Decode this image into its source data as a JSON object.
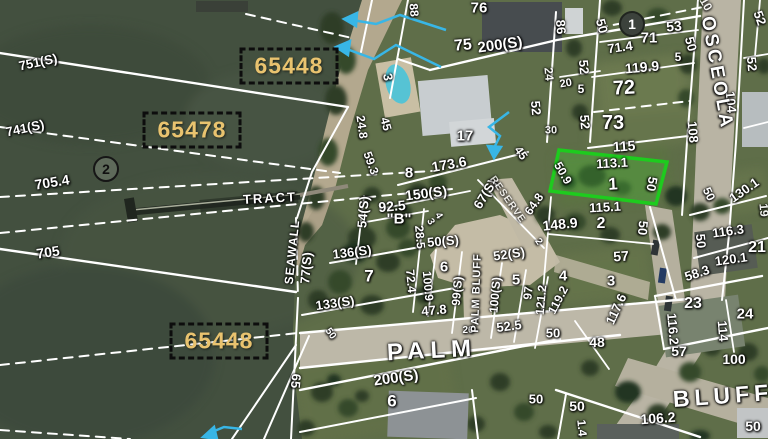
{
  "map": {
    "description": "Aerial parcel map with survey overlay",
    "colors": {
      "water": "#43503f",
      "land": "#5f6e49",
      "highlight_green": "#1ecb1e",
      "arrow_cyan": "#38b6e6",
      "parcel_id_text": "#e9c36f",
      "parcel_line": "#ffffff"
    },
    "highlight_parcel": {
      "lot": "1",
      "points": "559,150 667,162 656,204 550,191"
    },
    "parcel_id_boxes": [
      {
        "id": "65448",
        "x": 289,
        "y": 66
      },
      {
        "id": "65478",
        "x": 192,
        "y": 130
      },
      {
        "id": "65448",
        "x": 219,
        "y": 341
      }
    ],
    "circle_markers": [
      {
        "n": "2",
        "x": 106,
        "y": 169,
        "variant": "outline"
      },
      {
        "n": "1",
        "x": 632,
        "y": 24,
        "variant": "filled"
      }
    ],
    "street_labels": [
      {
        "t": "OSCEOLA",
        "x": 717,
        "y": 73,
        "r": 80,
        "s": 19,
        "sp": 3
      },
      {
        "t": "PALM",
        "x": 432,
        "y": 351,
        "r": -3,
        "s": 24,
        "sp": 6
      },
      {
        "t": "BLUFF",
        "x": 723,
        "y": 396,
        "r": -4,
        "s": 23,
        "sp": 5
      },
      {
        "t": "PALM BLUFF",
        "x": 477,
        "y": 293,
        "r": -88,
        "s": 11,
        "sp": 1
      },
      {
        "t": "SEAWALL",
        "x": 292,
        "y": 252,
        "r": -84,
        "s": 12,
        "sp": 1
      },
      {
        "t": "TRACT",
        "x": 270,
        "y": 198,
        "r": -3,
        "s": 13,
        "sp": 2
      },
      {
        "t": "RESERVE",
        "x": 507,
        "y": 200,
        "r": 55,
        "s": 10,
        "sp": 1,
        "o": 0.75
      }
    ],
    "labels": [
      {
        "t": "751(S)",
        "x": 38,
        "y": 62,
        "r": -12,
        "s": 13
      },
      {
        "t": "741(S)",
        "x": 25,
        "y": 128,
        "r": -12,
        "s": 13
      },
      {
        "t": "705.4",
        "x": 52,
        "y": 182,
        "r": -9,
        "s": 14
      },
      {
        "t": "705",
        "x": 48,
        "y": 252,
        "r": -8,
        "s": 14
      },
      {
        "t": "65",
        "x": 296,
        "y": 381,
        "r": 95,
        "s": 13
      },
      {
        "t": "88",
        "x": 414,
        "y": 10,
        "r": 85,
        "s": 12
      },
      {
        "t": "76",
        "x": 479,
        "y": 8,
        "r": 0,
        "s": 15
      },
      {
        "t": "75",
        "x": 463,
        "y": 46,
        "r": -5,
        "s": 16
      },
      {
        "t": "200(S)",
        "x": 500,
        "y": 45,
        "r": -8,
        "s": 15
      },
      {
        "t": "3",
        "x": 388,
        "y": 77,
        "r": 80,
        "s": 13
      },
      {
        "t": "24.8",
        "x": 362,
        "y": 127,
        "r": 82,
        "s": 12
      },
      {
        "t": "45",
        "x": 386,
        "y": 124,
        "r": 75,
        "s": 12
      },
      {
        "t": "17",
        "x": 465,
        "y": 136,
        "r": 0,
        "s": 15
      },
      {
        "t": "52",
        "x": 536,
        "y": 108,
        "r": 85,
        "s": 13
      },
      {
        "t": "59.3",
        "x": 371,
        "y": 163,
        "r": 70,
        "s": 12
      },
      {
        "t": "86",
        "x": 561,
        "y": 27,
        "r": 85,
        "s": 13
      },
      {
        "t": "50",
        "x": 602,
        "y": 26,
        "r": 75,
        "s": 13
      },
      {
        "t": "71",
        "x": 649,
        "y": 38,
        "r": 0,
        "s": 15
      },
      {
        "t": "53",
        "x": 674,
        "y": 26,
        "r": -5,
        "s": 14
      },
      {
        "t": "71.4",
        "x": 620,
        "y": 47,
        "r": -8,
        "s": 13
      },
      {
        "t": "50",
        "x": 691,
        "y": 44,
        "r": 75,
        "s": 13
      },
      {
        "t": "5",
        "x": 678,
        "y": 57,
        "r": 0,
        "s": 12
      },
      {
        "t": "119.9",
        "x": 642,
        "y": 67,
        "r": -5,
        "s": 14
      },
      {
        "t": "52",
        "x": 584,
        "y": 67,
        "r": 85,
        "s": 13
      },
      {
        "t": "72",
        "x": 624,
        "y": 88,
        "r": -3,
        "s": 20
      },
      {
        "t": "24",
        "x": 549,
        "y": 74,
        "r": 85,
        "s": 12,
        "o": 0.9
      },
      {
        "t": "20",
        "x": 566,
        "y": 84,
        "r": -10,
        "s": 11
      },
      {
        "t": "5",
        "x": 581,
        "y": 89,
        "r": 0,
        "s": 12
      },
      {
        "t": "52",
        "x": 585,
        "y": 122,
        "r": 85,
        "s": 13
      },
      {
        "t": "73",
        "x": 613,
        "y": 123,
        "r": 0,
        "s": 20
      },
      {
        "t": "30",
        "x": 551,
        "y": 131,
        "r": 0,
        "s": 11,
        "o": 0.9
      },
      {
        "t": "115",
        "x": 624,
        "y": 146,
        "r": -4,
        "s": 14
      },
      {
        "t": "108",
        "x": 693,
        "y": 132,
        "r": 85,
        "s": 13
      },
      {
        "t": "104",
        "x": 731,
        "y": 102,
        "r": 85,
        "s": 13
      },
      {
        "t": "52",
        "x": 760,
        "y": 18,
        "r": 70,
        "s": 13
      },
      {
        "t": "52",
        "x": 752,
        "y": 64,
        "r": 85,
        "s": 13
      },
      {
        "t": "10",
        "x": 706,
        "y": 4,
        "r": 60,
        "s": 12,
        "o": 0.85
      },
      {
        "t": "8",
        "x": 409,
        "y": 173,
        "r": 0,
        "s": 15
      },
      {
        "t": "173.6",
        "x": 449,
        "y": 164,
        "r": -10,
        "s": 14
      },
      {
        "t": "45",
        "x": 521,
        "y": 153,
        "r": 55,
        "s": 12
      },
      {
        "t": "150(S)",
        "x": 426,
        "y": 193,
        "r": -7,
        "s": 14
      },
      {
        "t": "67(S)",
        "x": 485,
        "y": 194,
        "r": -58,
        "s": 13
      },
      {
        "t": "64.8",
        "x": 534,
        "y": 204,
        "r": -55,
        "s": 12
      },
      {
        "t": "92.5",
        "x": 392,
        "y": 206,
        "r": -5,
        "s": 14
      },
      {
        "t": "54(S)",
        "x": 363,
        "y": 212,
        "r": -85,
        "s": 13
      },
      {
        "t": "\"B\"",
        "x": 399,
        "y": 219,
        "r": 0,
        "s": 15
      },
      {
        "t": "3",
        "x": 430,
        "y": 222,
        "r": 60,
        "s": 10
      },
      {
        "t": "4",
        "x": 438,
        "y": 216,
        "r": 60,
        "s": 10
      },
      {
        "t": "28.5",
        "x": 420,
        "y": 237,
        "r": 85,
        "s": 12
      },
      {
        "t": "50(S)",
        "x": 443,
        "y": 241,
        "r": -5,
        "s": 13
      },
      {
        "t": "2",
        "x": 538,
        "y": 242,
        "r": 55,
        "s": 10
      },
      {
        "t": "52(S)",
        "x": 509,
        "y": 254,
        "r": -8,
        "s": 13
      },
      {
        "t": "148.9",
        "x": 560,
        "y": 224,
        "r": -6,
        "s": 14
      },
      {
        "t": "136(S)",
        "x": 352,
        "y": 252,
        "r": -7,
        "s": 13
      },
      {
        "t": "77(S)",
        "x": 306,
        "y": 268,
        "r": -85,
        "s": 13
      },
      {
        "t": "7",
        "x": 369,
        "y": 276,
        "r": 0,
        "s": 17
      },
      {
        "t": "72.4",
        "x": 411,
        "y": 281,
        "r": 85,
        "s": 12
      },
      {
        "t": "100.9",
        "x": 428,
        "y": 286,
        "r": 85,
        "s": 12
      },
      {
        "t": "6",
        "x": 444,
        "y": 267,
        "r": 0,
        "s": 15
      },
      {
        "t": "99(S)",
        "x": 457,
        "y": 291,
        "r": -85,
        "s": 12
      },
      {
        "t": "100(S)",
        "x": 495,
        "y": 295,
        "r": -85,
        "s": 12
      },
      {
        "t": "5",
        "x": 516,
        "y": 280,
        "r": 0,
        "s": 15
      },
      {
        "t": "97",
        "x": 528,
        "y": 293,
        "r": -85,
        "s": 12
      },
      {
        "t": "121.2",
        "x": 541,
        "y": 300,
        "r": -85,
        "s": 12
      },
      {
        "t": "26",
        "x": 468,
        "y": 331,
        "r": 0,
        "s": 10
      },
      {
        "t": "47.8",
        "x": 434,
        "y": 310,
        "r": -5,
        "s": 13
      },
      {
        "t": "52.5",
        "x": 509,
        "y": 326,
        "r": -7,
        "s": 13
      },
      {
        "t": "133(S)",
        "x": 335,
        "y": 303,
        "r": -8,
        "s": 13
      },
      {
        "t": "50",
        "x": 330,
        "y": 334,
        "r": 55,
        "s": 10
      },
      {
        "t": "50.9",
        "x": 563,
        "y": 173,
        "r": 60,
        "s": 12
      },
      {
        "t": "113.1",
        "x": 612,
        "y": 163,
        "r": -3,
        "s": 13
      },
      {
        "t": "1",
        "x": 613,
        "y": 184,
        "r": -3,
        "s": 17
      },
      {
        "t": "50",
        "x": 652,
        "y": 184,
        "r": 100,
        "s": 13
      },
      {
        "t": "115.1",
        "x": 605,
        "y": 207,
        "r": -3,
        "s": 13
      },
      {
        "t": "2",
        "x": 601,
        "y": 224,
        "r": 0,
        "s": 16
      },
      {
        "t": "50",
        "x": 643,
        "y": 228,
        "r": 95,
        "s": 13
      },
      {
        "t": "57",
        "x": 621,
        "y": 256,
        "r": -4,
        "s": 14
      },
      {
        "t": "4",
        "x": 563,
        "y": 276,
        "r": 0,
        "s": 15
      },
      {
        "t": "3",
        "x": 611,
        "y": 281,
        "r": 0,
        "s": 15
      },
      {
        "t": "130.1",
        "x": 744,
        "y": 190,
        "r": -35,
        "s": 13
      },
      {
        "t": "50",
        "x": 709,
        "y": 194,
        "r": 65,
        "s": 12
      },
      {
        "t": "19",
        "x": 764,
        "y": 210,
        "r": 85,
        "s": 12,
        "o": 0.9
      },
      {
        "t": "116.3",
        "x": 728,
        "y": 231,
        "r": -8,
        "s": 13
      },
      {
        "t": "21",
        "x": 757,
        "y": 248,
        "r": 0,
        "s": 16
      },
      {
        "t": "50",
        "x": 701,
        "y": 241,
        "r": 85,
        "s": 13
      },
      {
        "t": "120.1",
        "x": 731,
        "y": 259,
        "r": -8,
        "s": 13
      },
      {
        "t": "58.3",
        "x": 697,
        "y": 273,
        "r": -18,
        "s": 13
      },
      {
        "t": "117.6",
        "x": 616,
        "y": 309,
        "r": -65,
        "s": 13
      },
      {
        "t": "119.2",
        "x": 558,
        "y": 300,
        "r": -62,
        "s": 12
      },
      {
        "t": "50",
        "x": 553,
        "y": 333,
        "r": 0,
        "s": 13
      },
      {
        "t": "48",
        "x": 597,
        "y": 342,
        "r": 0,
        "s": 14
      },
      {
        "t": "23",
        "x": 693,
        "y": 304,
        "r": 0,
        "s": 16
      },
      {
        "t": "116.2",
        "x": 673,
        "y": 329,
        "r": 85,
        "s": 13
      },
      {
        "t": "24",
        "x": 745,
        "y": 314,
        "r": 0,
        "s": 15
      },
      {
        "t": "114",
        "x": 723,
        "y": 331,
        "r": 85,
        "s": 13
      },
      {
        "t": "57",
        "x": 679,
        "y": 351,
        "r": 0,
        "s": 14
      },
      {
        "t": "100",
        "x": 734,
        "y": 359,
        "r": 0,
        "s": 14
      },
      {
        "t": "50",
        "x": 577,
        "y": 406,
        "r": 0,
        "s": 14
      },
      {
        "t": "106.2",
        "x": 658,
        "y": 418,
        "r": -4,
        "s": 14
      },
      {
        "t": "50",
        "x": 753,
        "y": 426,
        "r": 0,
        "s": 14
      },
      {
        "t": "1.4",
        "x": 582,
        "y": 428,
        "r": 85,
        "s": 12
      },
      {
        "t": "6",
        "x": 392,
        "y": 401,
        "r": 0,
        "s": 17
      },
      {
        "t": "50",
        "x": 536,
        "y": 399,
        "r": 0,
        "s": 13
      },
      {
        "t": "200(S)",
        "x": 396,
        "y": 378,
        "r": -8,
        "s": 15
      }
    ]
  }
}
